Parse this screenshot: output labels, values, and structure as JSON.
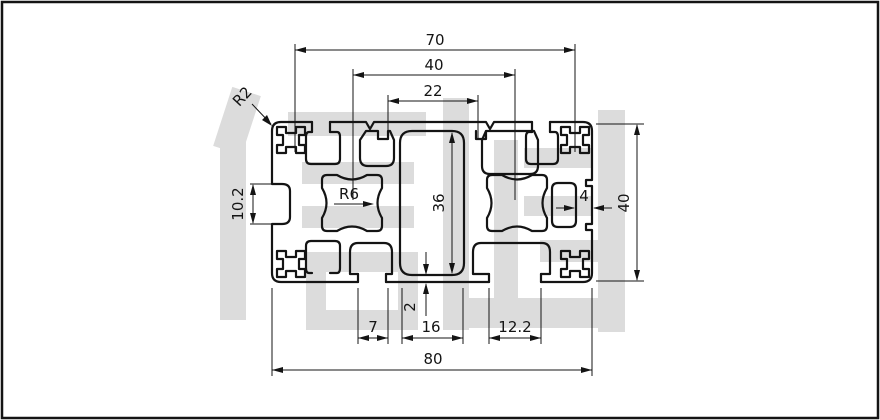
{
  "drawing": {
    "title": "aluminium-profile-8040-cross-section",
    "watermark": {
      "text": "信牌",
      "color": "#dcdcdc"
    },
    "colors": {
      "line": "#141414",
      "dimension": "#141414",
      "background": "#ffffff"
    },
    "dimensions": {
      "top_outer": "70",
      "top_mid": "40",
      "top_inner": "22",
      "corner_radius": "R2",
      "left_slot_height": "10.2",
      "core_radius": "R6",
      "channel_height": "36",
      "right_groove_depth": "4",
      "overall_height": "40",
      "bottom_left_slot": "7",
      "bottom_wall": "2",
      "bottom_center_slot": "16",
      "bottom_right_slot": "12.2",
      "overall_width": "80"
    }
  }
}
